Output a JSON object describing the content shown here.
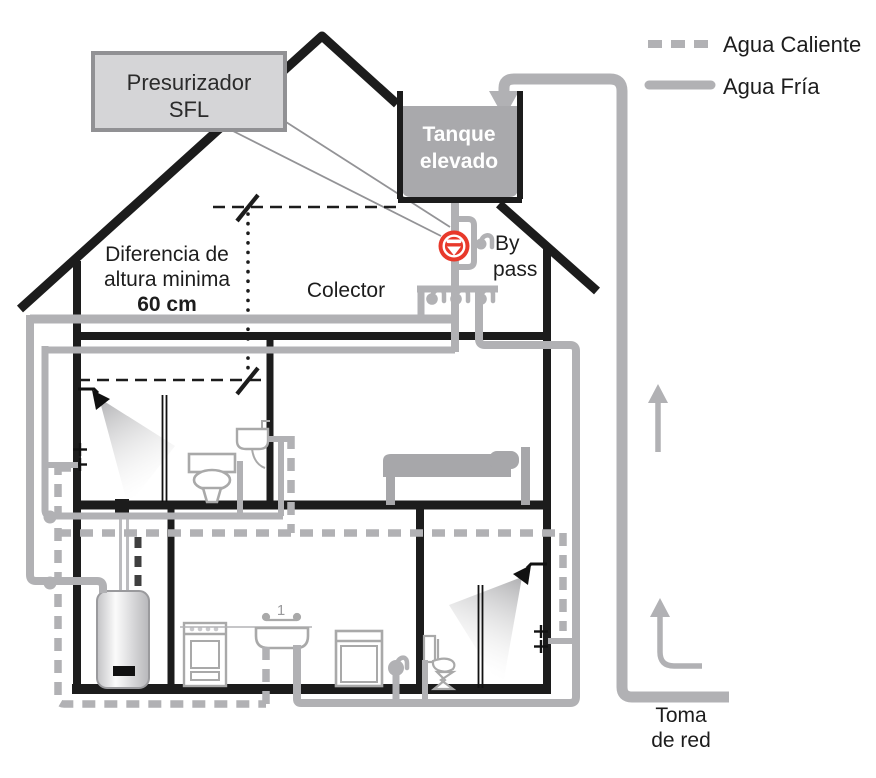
{
  "diagram": {
    "title_none": "",
    "pressurizer": {
      "line1": "Presurizador",
      "line2": "SFL"
    },
    "tank": {
      "line1": "Tanque",
      "line2": "elevado"
    },
    "height_note": {
      "line1": "Diferencia de",
      "line2": "altura minima",
      "line3": "60 cm"
    },
    "collector_label": "Colector",
    "bypass": {
      "line1": "By",
      "line2": "pass"
    },
    "mains_intake": {
      "line1": "Toma",
      "line2": "de red"
    },
    "kitchen_faucet_number": "1",
    "legend": {
      "items": [
        {
          "label": "Agua Caliente",
          "style": "dashed"
        },
        {
          "label": "Agua Fría",
          "style": "solid"
        }
      ]
    },
    "icons": [
      "check-valve-icon",
      "faucet-tap-icon",
      "flow-arrow-icon",
      "shower-head-icon"
    ],
    "colors": {
      "pipe_gray": "#b1b1b4",
      "heater_hot_stub_dark": "#3f3f3f",
      "structure_black": "#1c1c1c",
      "valve_red": "#e8392b",
      "tank_gray": "#a9a9ac",
      "pressurizer_fill": "#d5d5d7",
      "pressurizer_border": "#919194",
      "fixture_outline": "#a9a9a9"
    }
  }
}
